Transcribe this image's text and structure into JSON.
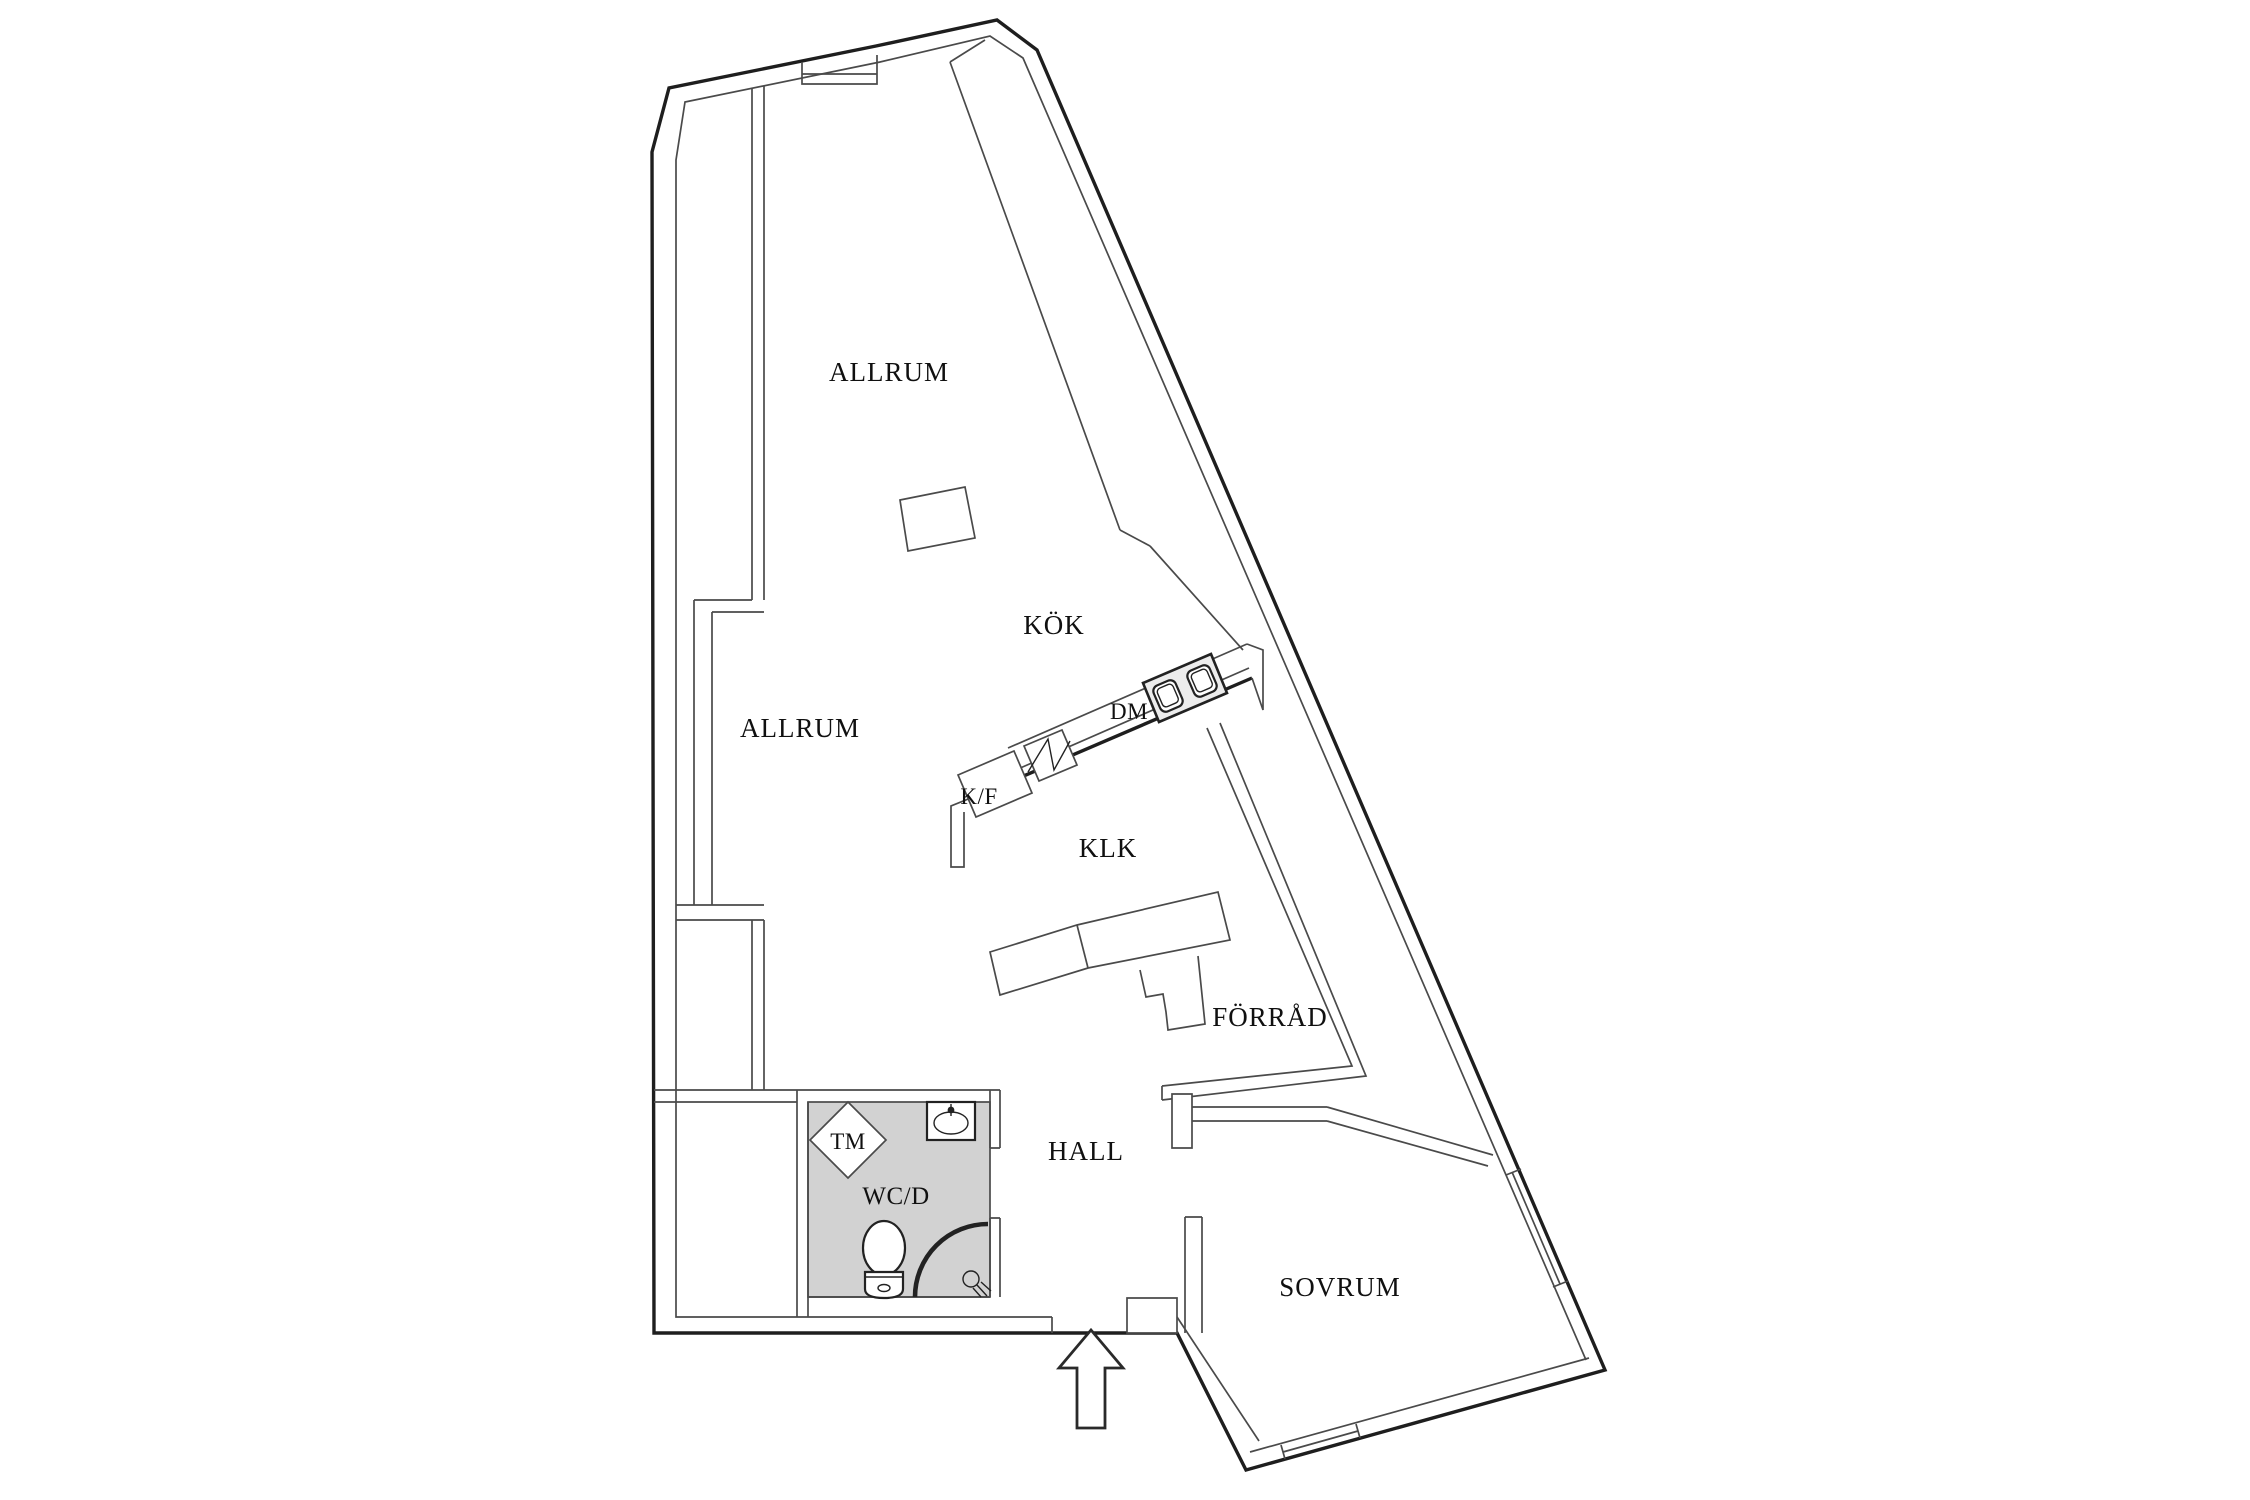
{
  "canvas": {
    "width": 2250,
    "height": 1500,
    "background": "#ffffff"
  },
  "colors": {
    "wall_heavy": "#1e1e1e",
    "wall_light": "#4a4a4a",
    "fixture": "#222222",
    "wet_floor": "#d2d2d2",
    "text": "#101010"
  },
  "plan": {
    "type": "apartment-floor-plan",
    "rooms": {
      "allrum_top": {
        "label": "ALLRUM"
      },
      "kok": {
        "label": "KÖK"
      },
      "allrum_left": {
        "label": "ALLRUM"
      },
      "klk": {
        "label": "KLK"
      },
      "forrad": {
        "label": "FÖRRÅD"
      },
      "hall": {
        "label": "HALL"
      },
      "wcd": {
        "label": "WC/D"
      },
      "sovrum": {
        "label": "SOVRUM"
      }
    },
    "fixtures": {
      "dm": {
        "label": "DM"
      },
      "kf": {
        "label": "K/F"
      },
      "tm": {
        "label": "TM"
      }
    },
    "entrance": {
      "symbol": "arrow-up"
    }
  }
}
